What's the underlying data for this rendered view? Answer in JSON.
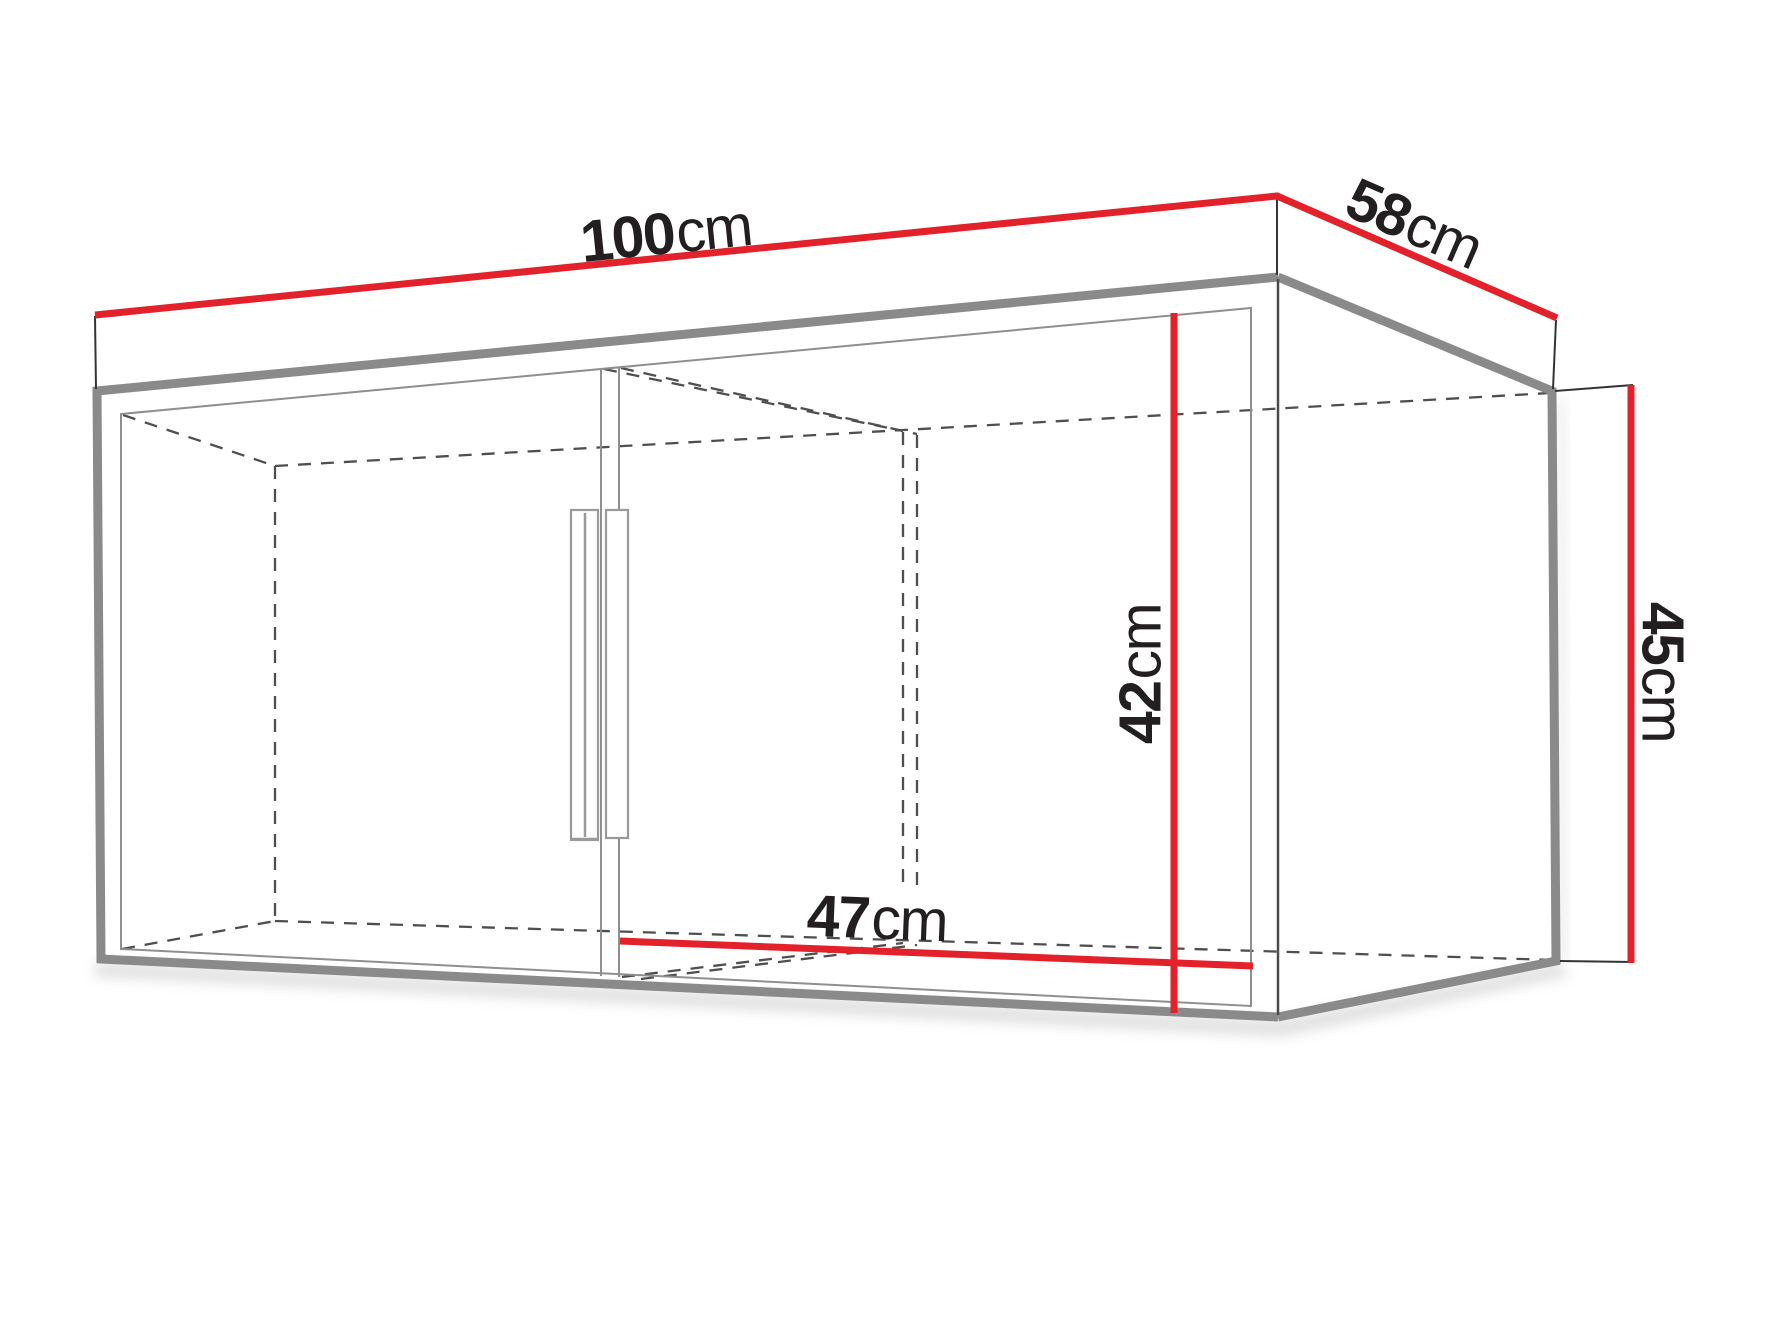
{
  "diagram": {
    "kind": "furniture-dimension-drawing",
    "subject": "two-door wall cabinet shown in perspective with overall and internal dimensions"
  },
  "colors": {
    "dimension_red": "#e3212a",
    "edge_gray": "#8a8a8a",
    "inner_gray": "#8f8f8f",
    "line_dark": "#4a4a4a",
    "dash_gray": "#4f4f4f",
    "extension_dark": "#333333",
    "handle_gray": "#9a9a9a",
    "shadow": "#c9c9c9",
    "label_text": "#231f20",
    "background": "#ffffff"
  },
  "dimensions": {
    "width": {
      "value": "100",
      "unit": "cm"
    },
    "depth": {
      "value": "58",
      "unit": "cm"
    },
    "height": {
      "value": "45",
      "unit": "cm"
    },
    "inner_height": {
      "value": "42",
      "unit": "cm"
    },
    "inner_depth": {
      "value": "47",
      "unit": "cm"
    }
  }
}
